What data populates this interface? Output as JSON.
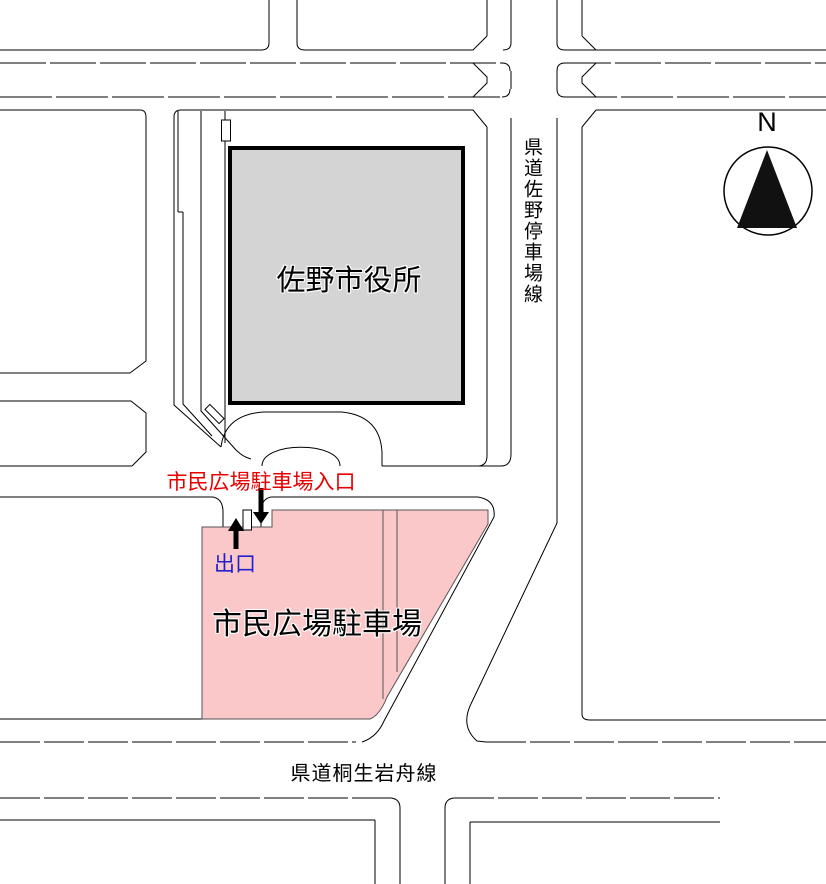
{
  "labels": {
    "city_hall": "佐野市役所",
    "parking_lot": "市民広場駐車場",
    "parking_entrance": "市民広場駐車場入口",
    "exit": "出口",
    "road_vertical": "県道佐野停車場線",
    "road_bottom": "県道桐生岩舟線",
    "compass_north": "N"
  },
  "colors": {
    "city_hall_fill": "#d4d4d4",
    "parking_fill": "#fac8c8",
    "parking_outline": "#555555",
    "entrance_text": "#e60000",
    "exit_text": "#2222cc",
    "road_line": "#000000",
    "arrow_fill": "#000000",
    "compass_fill": "#111111"
  }
}
